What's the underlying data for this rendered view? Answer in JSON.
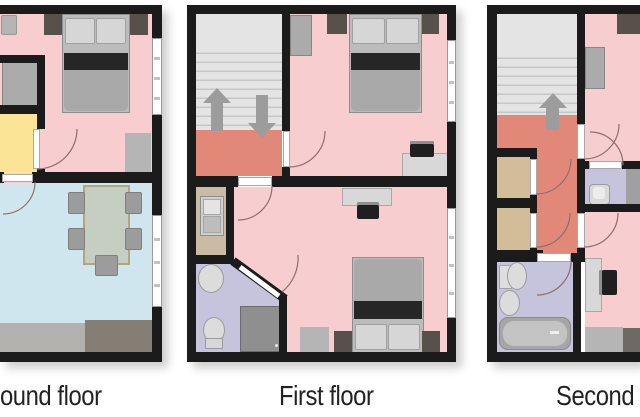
{
  "figure": {
    "type": "house-floor-plans",
    "panels": 3
  },
  "labels": {
    "ground": "ound floor",
    "first": "First floor",
    "second": "Second f"
  },
  "colors": {
    "wall": "#1b1b1b",
    "bedroom_pink": "#f8cdcf",
    "landing_salmon": "#e28879",
    "hall_yellow": "#fbe495",
    "living_blue": "#cfe6ee",
    "bath_lavender": "#c5c4dc",
    "closet_tan": "#d3bd98",
    "kitchen_tan": "#cbbaa4",
    "stairs": "#e4e4e4",
    "furniture_gray": "#ababab",
    "furniture_dark_brown": "#57504b",
    "counter_light": "#b3b1ae",
    "counter_dark": "#847e74",
    "arrow_gray": "#9c9c9c",
    "door_arc": "#8d6e6e",
    "window": "#ffffff"
  },
  "floors": [
    {
      "label": "ound floor",
      "rooms": [
        "bedroom (pink)",
        "entrance hall (yellow)",
        "living-dining room (blue)"
      ],
      "furniture": [
        "double-bed",
        "two nightstands",
        "wardrobe",
        "small fixture",
        "dining-table with five chairs",
        "counter"
      ]
    },
    {
      "label": "First floor",
      "rooms": [
        "staircase with landing (salmon)",
        "bedroom top (pink)",
        "bedroom bottom (pink)",
        "kitchenette (tan)",
        "bathroom (lavender)"
      ],
      "furniture": [
        "double-bed x2",
        "nightstands",
        "wardrobe",
        "desk with chair x2",
        "kitchen-sink",
        "wash-basin",
        "toilet",
        "shower"
      ],
      "stairs_arrows": [
        "up",
        "down"
      ]
    },
    {
      "label": "Second f",
      "rooms": [
        "staircase with landing and hallway (salmon)",
        "bedroom top (pink)",
        "room bottom (pink)",
        "closet x2 (tan)",
        "bathroom (lavender)",
        "wc (lavender)"
      ],
      "furniture": [
        "wardrobe",
        "desk with chair",
        "wash-basin",
        "toilet x2",
        "bathtub",
        "dresser"
      ],
      "stairs_arrows": [
        "up"
      ]
    }
  ]
}
